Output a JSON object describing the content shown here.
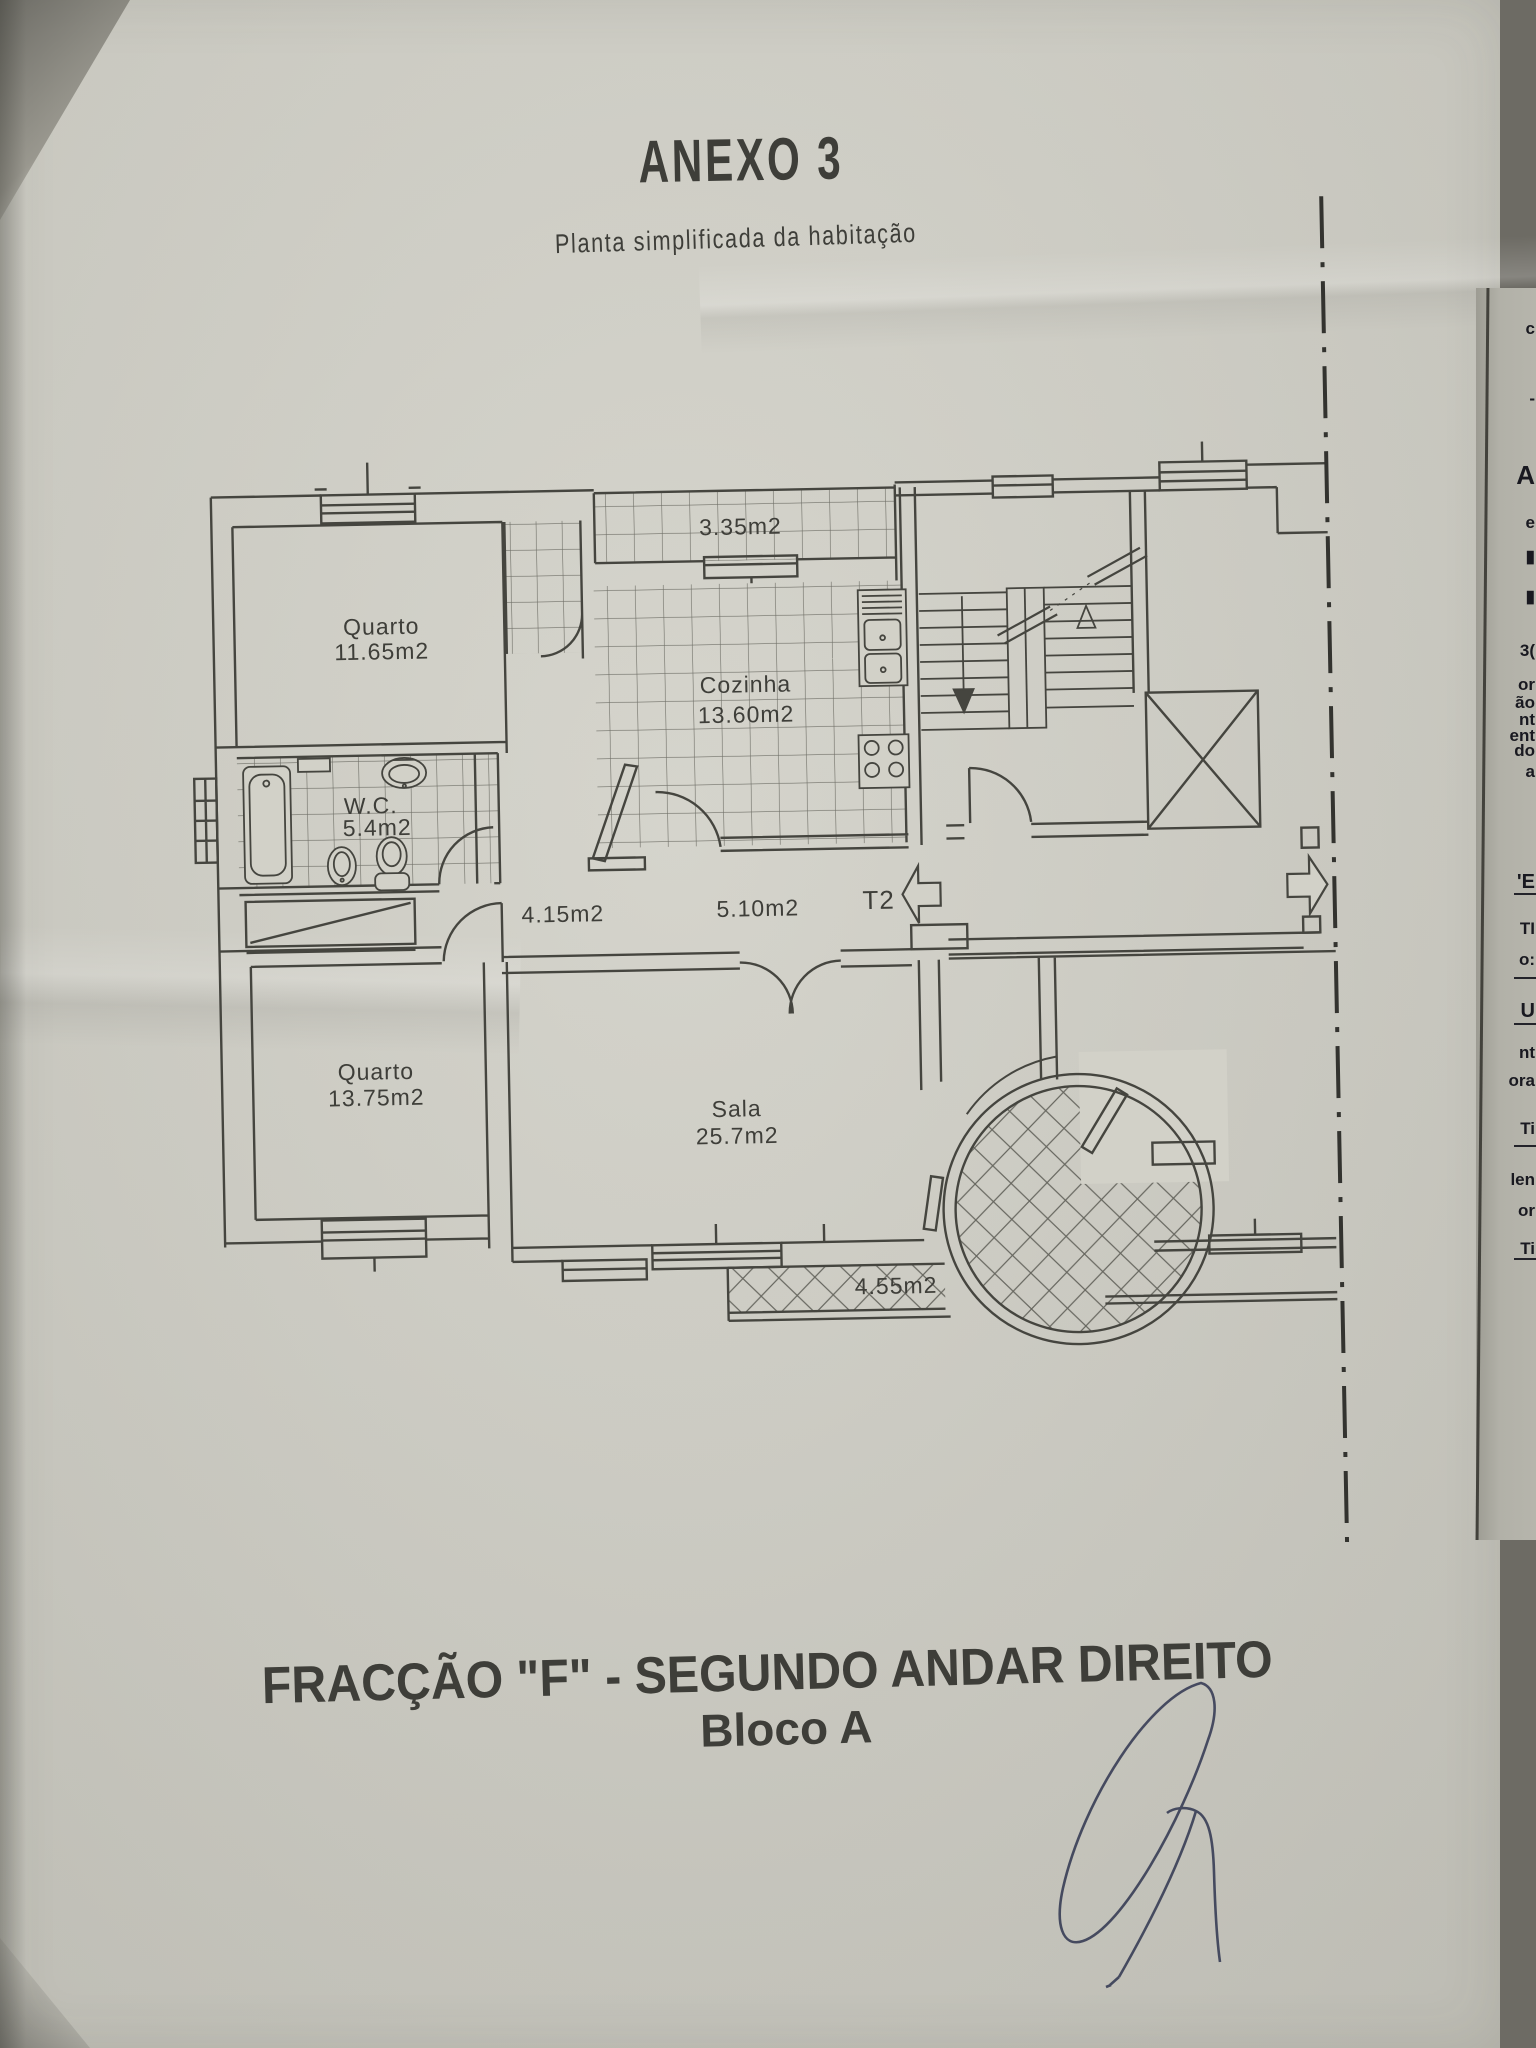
{
  "document": {
    "title": "ANEXO 3",
    "subtitle": "Planta simplificada da habitação",
    "footer_line1": "FRACÇÃO  \"F\" - SEGUNDO ANDAR DIREITO",
    "footer_line2": "Bloco A"
  },
  "plan": {
    "unit_type": "T2",
    "labels": {
      "bedroom1_name": "Quarto",
      "bedroom1_area": "11.65m2",
      "balcony_top_area": "3.35m2",
      "kitchen_name": "Cozinha",
      "kitchen_area": "13.60m2",
      "wc_name": "W.C.",
      "wc_area": "5.4m2",
      "hall_area": "4.15m2",
      "entry_hall_area": "5.10m2",
      "bedroom2_name": "Quarto",
      "bedroom2_area": "13.75m2",
      "living_name": "Sala",
      "living_area": "25.7m2",
      "balcony_bottom_area": "4.55m2"
    }
  },
  "side_page": {
    "fragments": [
      {
        "y": 320,
        "t": "c"
      },
      {
        "y": 390,
        "t": "-"
      },
      {
        "y": 462,
        "t": "A"
      },
      {
        "y": 514,
        "t": "e"
      },
      {
        "y": 548,
        "t": "▮"
      },
      {
        "y": 588,
        "t": "▮"
      },
      {
        "y": 642,
        "t": "3("
      },
      {
        "y": 676,
        "t": "or"
      },
      {
        "y": 694,
        "t": "ão"
      },
      {
        "y": 711,
        "t": "nt"
      },
      {
        "y": 727,
        "t": "ent"
      },
      {
        "y": 742,
        "t": "do"
      },
      {
        "y": 763,
        "t": "a"
      },
      {
        "y": 872,
        "t": "'E"
      },
      {
        "y": 920,
        "t": "TI"
      },
      {
        "y": 951,
        "t": "o:"
      },
      {
        "y": 1001,
        "t": "U"
      },
      {
        "y": 1044,
        "t": "nt"
      },
      {
        "y": 1072,
        "t": "ora"
      },
      {
        "y": 1120,
        "t": "Ti"
      },
      {
        "y": 1171,
        "t": "len"
      },
      {
        "y": 1202,
        "t": "or"
      },
      {
        "y": 1240,
        "t": "Ti"
      }
    ],
    "rule_y": [
      893,
      977,
      1023,
      1145,
      1258
    ]
  },
  "colors": {
    "paper": "#d2d1c8",
    "plan_ink": "#45453f",
    "text_ink": "#3c3c37",
    "title_ink": "#2b2b28",
    "signature_ink": "#3b4058"
  }
}
